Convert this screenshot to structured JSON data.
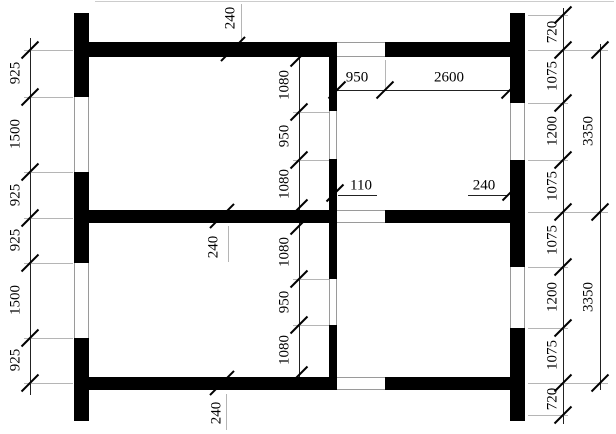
{
  "drawing": {
    "kind": "architectural-floor-plan",
    "unit": "mm",
    "colors": {
      "wall": "#000000",
      "dimension_line": "#222222",
      "extension_line": "#b5b5b5",
      "background": "#ffffff"
    },
    "labels": {
      "left_chain": [
        "925",
        "1500",
        "925",
        "925",
        "1500",
        "925"
      ],
      "interior_upper_chain": [
        "1080",
        "950",
        "1080"
      ],
      "interior_lower_chain": [
        "1080",
        "950",
        "1080"
      ],
      "top_interior_chain": [
        "950",
        "2600"
      ],
      "partition_thickness_callout": "110",
      "right_wall_thickness_callout": "240",
      "wall_thickness_callouts": [
        "240",
        "240",
        "240"
      ],
      "right_inner_chain": [
        "720",
        "1075",
        "1200",
        "1075",
        "1075",
        "1200",
        "1075",
        "720"
      ],
      "right_outer_chain": [
        "3350",
        "3350"
      ]
    }
  }
}
